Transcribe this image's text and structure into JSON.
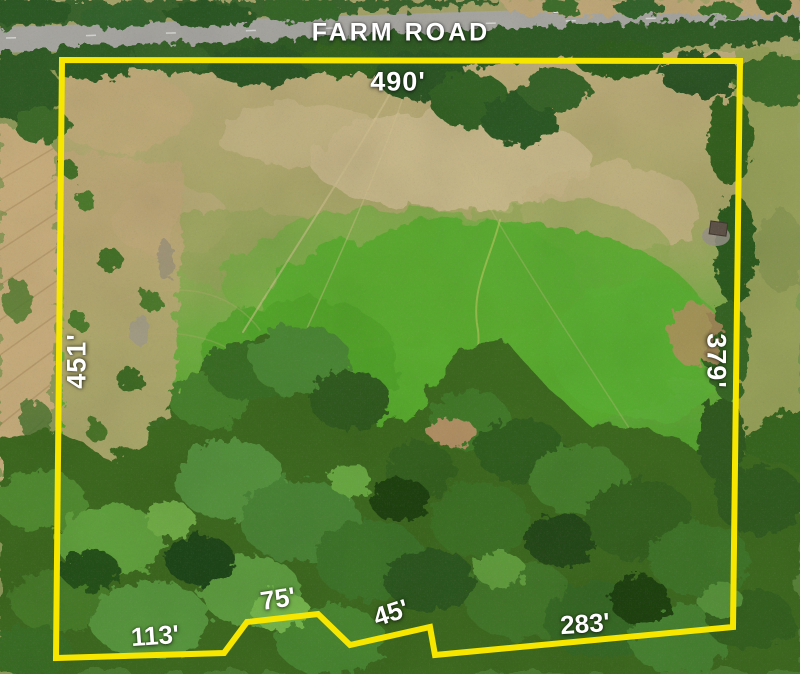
{
  "scene": {
    "description": "Aerial drone photo of a land parcel outlined in yellow with lot-line dimension labels",
    "road": {
      "label": "FARM ROAD"
    },
    "boundary": {
      "line_color": "#F7E600",
      "sides": [
        {
          "id": "north",
          "length": "490'"
        },
        {
          "id": "west",
          "length": "451'"
        },
        {
          "id": "east",
          "length": "379'"
        },
        {
          "id": "south-west",
          "length": "113'"
        },
        {
          "id": "south-step-1",
          "length": "75'"
        },
        {
          "id": "south-step-2",
          "length": "45'"
        },
        {
          "id": "south-east",
          "length": "283'"
        }
      ]
    },
    "colors": {
      "boundary_yellow": "#F7E600",
      "label_text": "#FFFFFF",
      "road_asphalt": "#A8A7A2",
      "dry_meadow": "#C0AE7C",
      "green_meadow": "#54AD2B",
      "forest_canopy": "#3A671F",
      "bare_dirt": "#C9AE7B"
    }
  }
}
